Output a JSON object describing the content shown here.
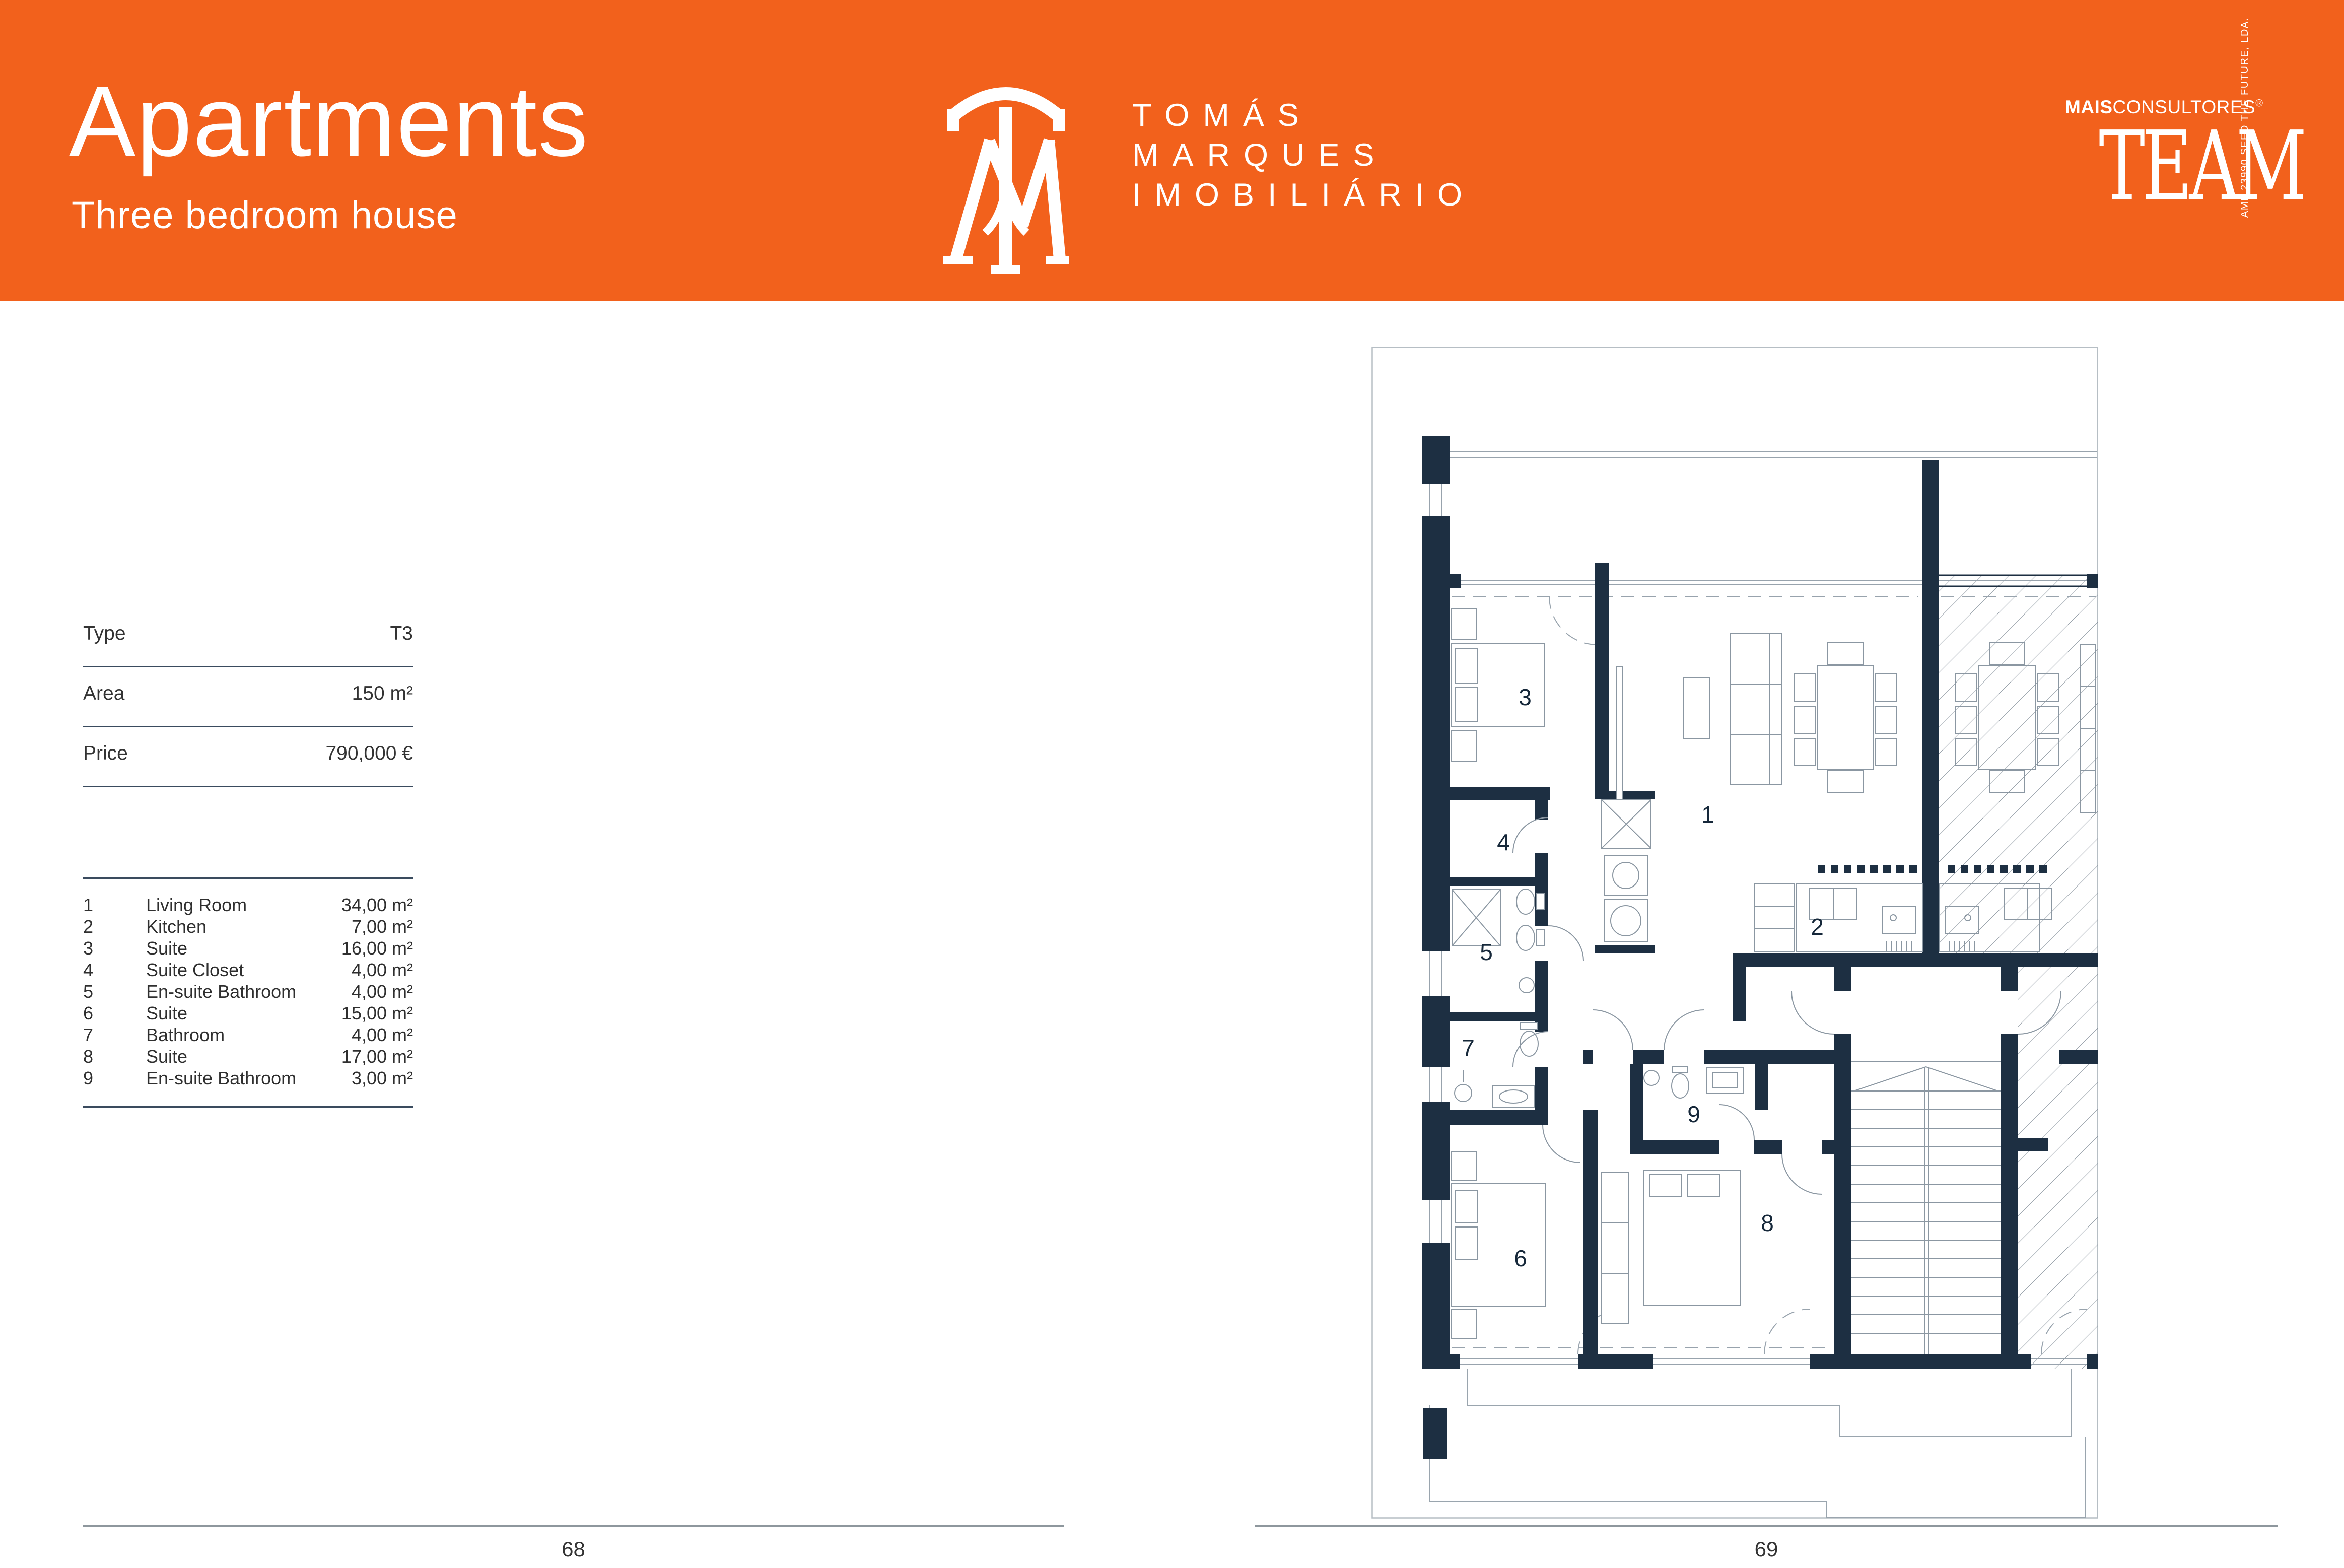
{
  "header": {
    "title": "Apartments",
    "subtitle": "Three bedroom house"
  },
  "brand": {
    "monogram": "TM",
    "name_line1": "TOMÁS",
    "name_line2": "MARQUES",
    "name_line3": "IMOBILIÁRIO"
  },
  "team": {
    "mais": "MAIS",
    "consultores": "CONSULTORES",
    "reg": "®",
    "word": "TEAM",
    "tagline": "AMI: 23990   SEED THE FUTURE, LDA."
  },
  "spec": {
    "rows": [
      {
        "label": "Type",
        "value": "T3"
      },
      {
        "label": "Area",
        "value": "150 m²"
      },
      {
        "label": "Price",
        "value": "790,000 €"
      }
    ]
  },
  "rooms": [
    {
      "num": "1",
      "name": "Living Room",
      "area": "34,00 m²"
    },
    {
      "num": "2",
      "name": "Kitchen",
      "area": "7,00 m²"
    },
    {
      "num": "3",
      "name": "Suite",
      "area": "16,00 m²"
    },
    {
      "num": "4",
      "name": "Suite Closet",
      "area": "4,00 m²"
    },
    {
      "num": "5",
      "name": "En-suite Bathroom",
      "area": "4,00 m²"
    },
    {
      "num": "6",
      "name": "Suite",
      "area": "15,00 m²"
    },
    {
      "num": "7",
      "name": "Bathroom",
      "area": "4,00 m²"
    },
    {
      "num": "8",
      "name": "Suite",
      "area": "17,00 m²"
    },
    {
      "num": "9",
      "name": "En-suite Bathroom",
      "area": "3,00 m²"
    }
  ],
  "plan": {
    "room_numbers": [
      "1",
      "2",
      "3",
      "4",
      "5",
      "6",
      "7",
      "8",
      "9"
    ]
  },
  "footer": {
    "left_page": "68",
    "right_page": "69"
  },
  "colors": {
    "accent": "#F2611C",
    "wall": "#1D2F42",
    "rule": "#3A4B5E",
    "hatch": "#76828E"
  }
}
